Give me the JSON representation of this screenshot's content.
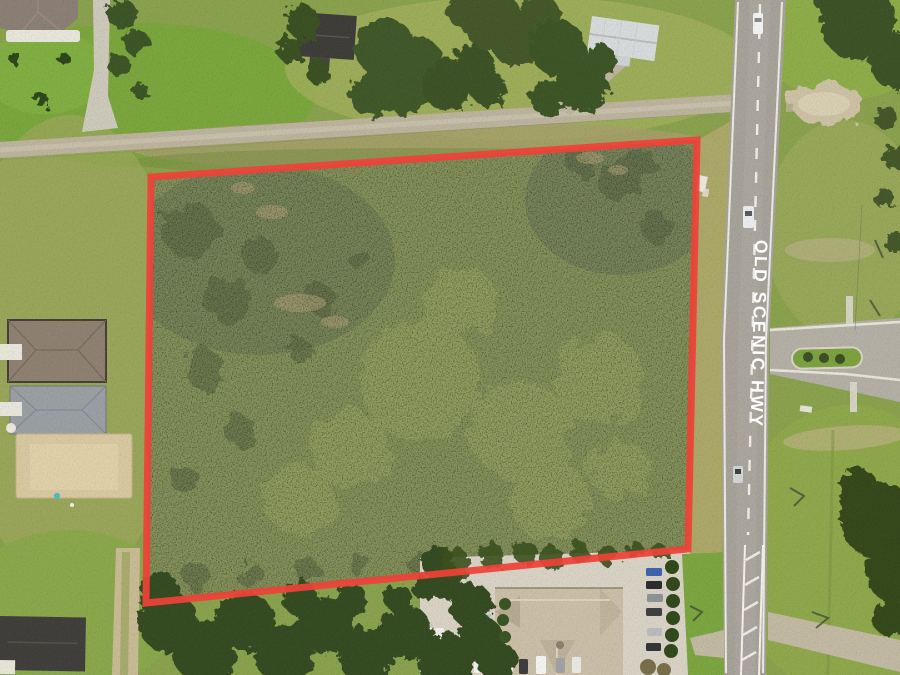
{
  "image": {
    "kind": "aerial-parcel-photo",
    "width": 900,
    "height": 675
  },
  "annotations": {
    "road_label": {
      "text": "OLD SCENIC HWY",
      "color": "#ffffff"
    },
    "parcel_boundary": {
      "color": "#ee4238",
      "points": "151,177 697,140 688,549 146,603",
      "stroke_width": "7"
    }
  },
  "palette": {
    "grass": "#8aa24e",
    "parcel_scrub": "#8c9a60",
    "asphalt": "#a7a39b",
    "gravel_road": "#bcb49e",
    "tree_canopy": "#41582a",
    "office_roof_tan": "#cbbfa8",
    "house_roof_gray": "#9aa0a3",
    "house_roof_dark": "#3e3d39",
    "concrete": "#d9d3c6"
  }
}
